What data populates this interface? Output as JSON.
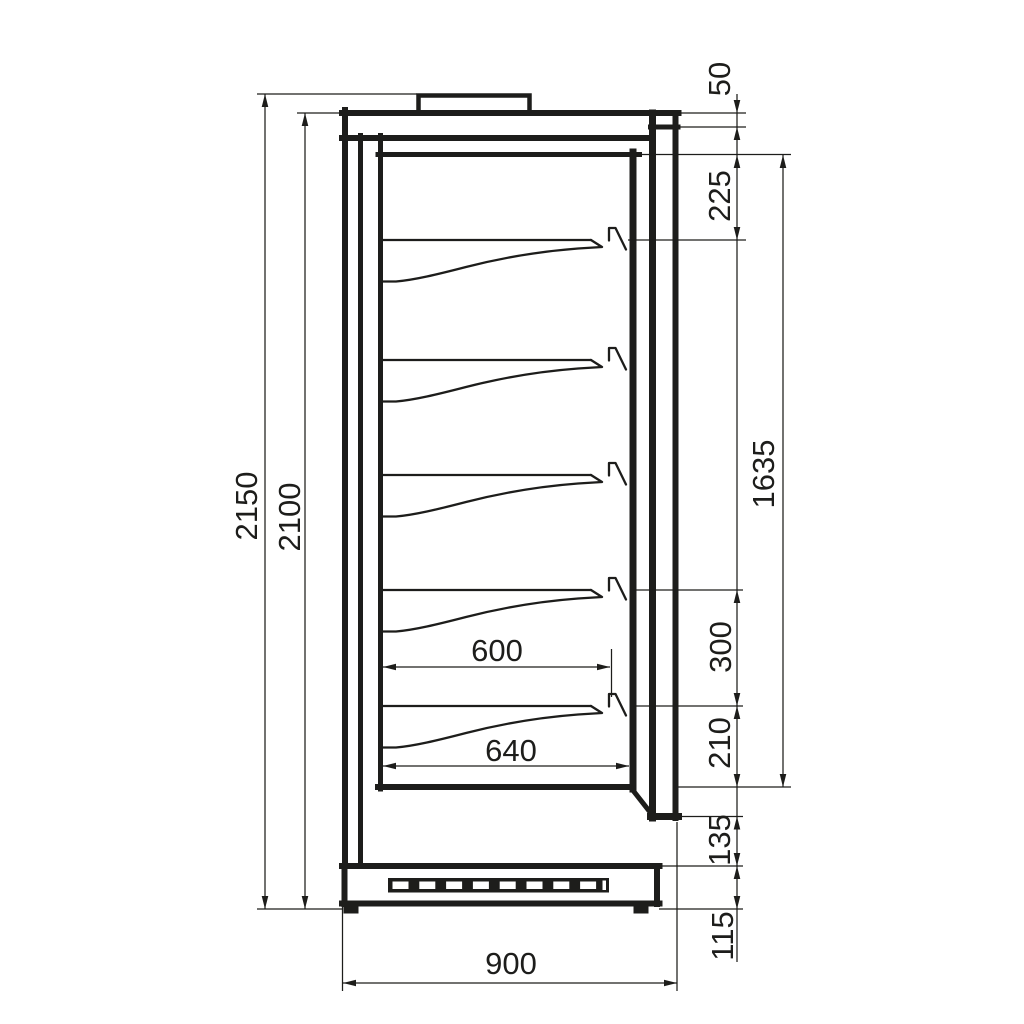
{
  "diagram": {
    "type": "technical-drawing-side-section",
    "subject": "refrigerated-display-cabinet",
    "line_color": "#1d1d1b",
    "background_color": "#ffffff",
    "shelf_count": 5,
    "dimensions": {
      "left": [
        {
          "label": "2150",
          "orientation": "vertical"
        },
        {
          "label": "2100",
          "orientation": "vertical"
        }
      ],
      "right_chain": [
        {
          "label": "50"
        },
        {
          "label": "225"
        },
        {
          "label": "300"
        },
        {
          "label": "210"
        },
        {
          "label": "135"
        },
        {
          "label": "115"
        }
      ],
      "right_overall": [
        {
          "label": "1635"
        }
      ],
      "internal": [
        {
          "label": "600"
        },
        {
          "label": "640"
        }
      ],
      "bottom": [
        {
          "label": "900"
        }
      ]
    }
  }
}
